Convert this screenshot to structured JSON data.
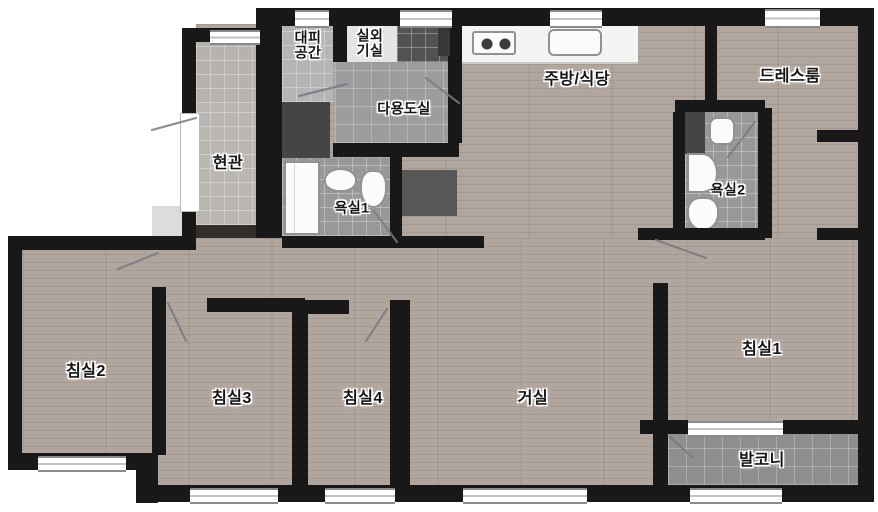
{
  "title": "apartment-floor-plan",
  "rooms": [
    {
      "id": "evacuation-space",
      "label": "대피\n공간"
    },
    {
      "id": "outdoor-unit-room",
      "label": "실외\n기실"
    },
    {
      "id": "utility-room",
      "label": "다용도실"
    },
    {
      "id": "kitchen-dining",
      "label": "주방/식당"
    },
    {
      "id": "dressroom",
      "label": "드레스룸"
    },
    {
      "id": "entrance",
      "label": "현관"
    },
    {
      "id": "bathroom1",
      "label": "욕실1"
    },
    {
      "id": "bathroom2",
      "label": "욕실2"
    },
    {
      "id": "bedroom2",
      "label": "침실2"
    },
    {
      "id": "bedroom3",
      "label": "침실3"
    },
    {
      "id": "bedroom4",
      "label": "침실4"
    },
    {
      "id": "living-room",
      "label": "거실"
    },
    {
      "id": "bedroom1",
      "label": "침실1"
    },
    {
      "id": "balcony",
      "label": "발코니"
    }
  ],
  "palette": {
    "wall": "#181818",
    "wood_floor": "#b1a69d",
    "tile_gray": "#9a9a9a",
    "dark_fixture": "#4a4a4a",
    "fixture_white": "#fbfbfb",
    "background": "#ffffff"
  }
}
